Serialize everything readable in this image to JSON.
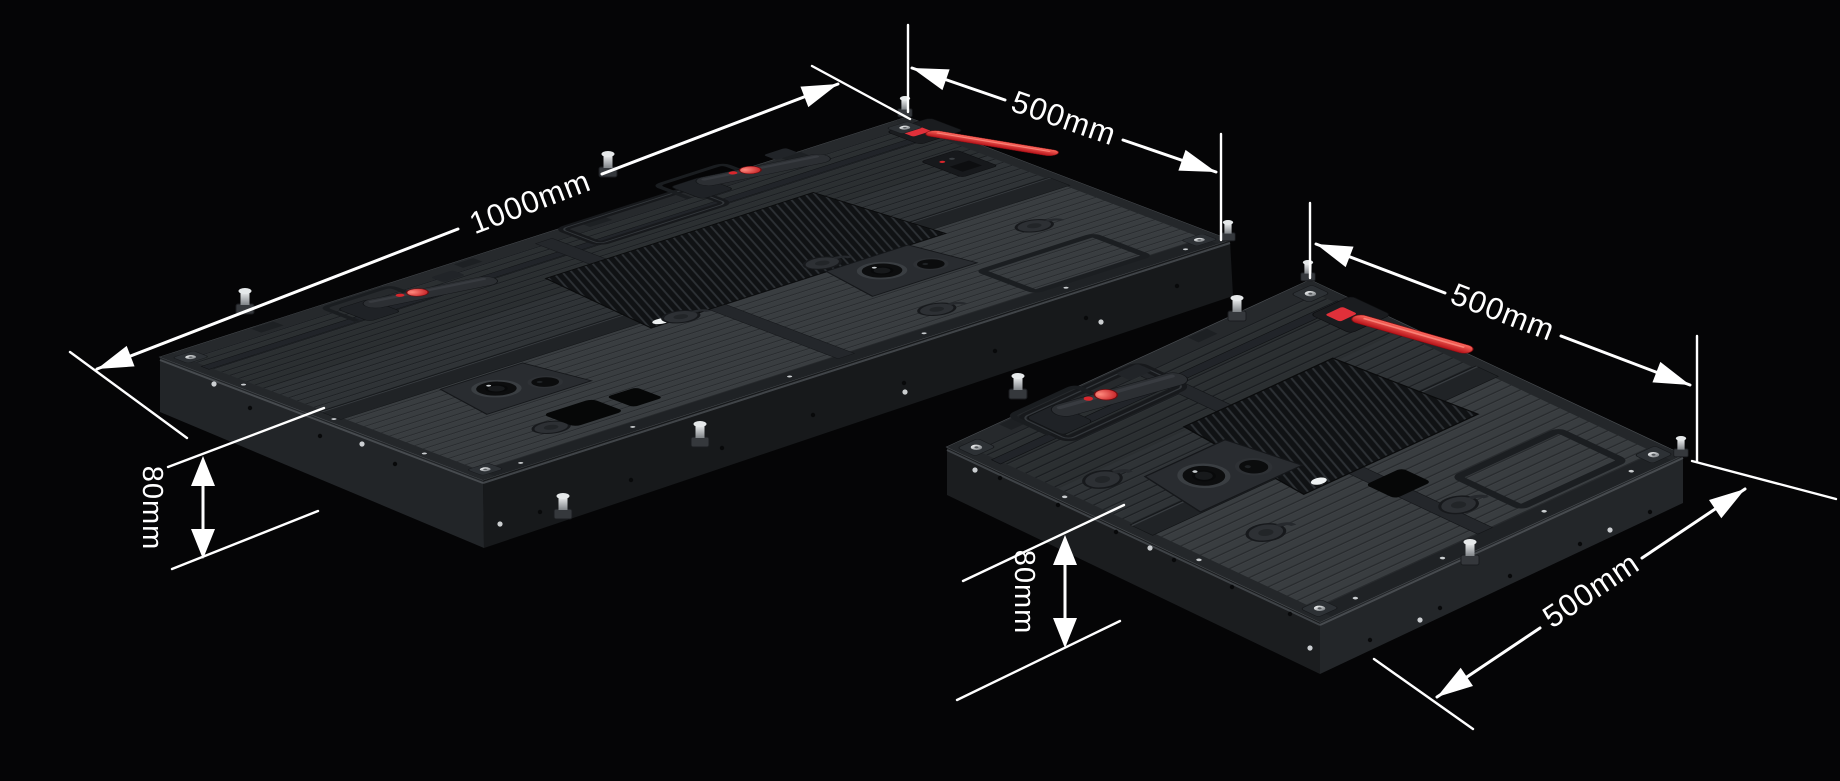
{
  "scene": {
    "background": "#050506",
    "dimension_line_color": "#ffffff",
    "accent_red": "#d8262c",
    "panel_body_color": "#2f3336"
  },
  "panels": [
    {
      "id": "large-cabinet",
      "description": "LED cabinet rear view, 1000 x 500 x 80 mm"
    },
    {
      "id": "small-cabinet",
      "description": "LED cabinet rear view, 500 x 500 x 80 mm"
    }
  ],
  "dimensions": {
    "left_panel": {
      "width": {
        "label": "1000mm"
      },
      "depth": {
        "label": "500mm"
      },
      "height": {
        "label": "80mm"
      }
    },
    "right_panel": {
      "depth_top": {
        "label": "500mm"
      },
      "depth_right": {
        "label": "500mm"
      },
      "height": {
        "label": "80mm"
      }
    }
  }
}
